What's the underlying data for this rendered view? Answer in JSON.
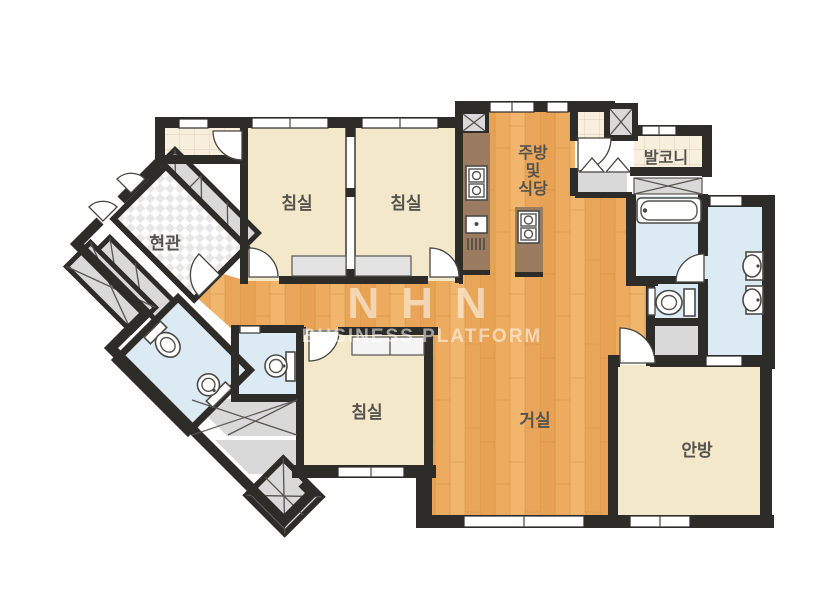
{
  "watermark": {
    "line1": "NHN",
    "line2": "BUSINESS PLATFORM"
  },
  "rooms": {
    "entrance": {
      "label": "현관"
    },
    "bedroom1": {
      "label": "침실"
    },
    "bedroom2": {
      "label": "침실"
    },
    "bedroom3": {
      "label": "침실"
    },
    "kitchen": {
      "label_line1": "주방",
      "label_line2": "및",
      "label_line3": "식당"
    },
    "balcony": {
      "label": "발코니"
    },
    "living": {
      "label": "거실"
    },
    "master": {
      "label": "안방"
    }
  },
  "colors": {
    "wall": "#2e2c29",
    "room_cream": "#f3e8ca",
    "wood": "#ecab5e",
    "counter_brown": "#9b7c60",
    "bath_blue": "#dceaf3",
    "closet_gray": "#d9d9d9",
    "tile_beige": "#f8efdc",
    "label_text": "#55534d",
    "watermark_white": "#ffffff"
  }
}
